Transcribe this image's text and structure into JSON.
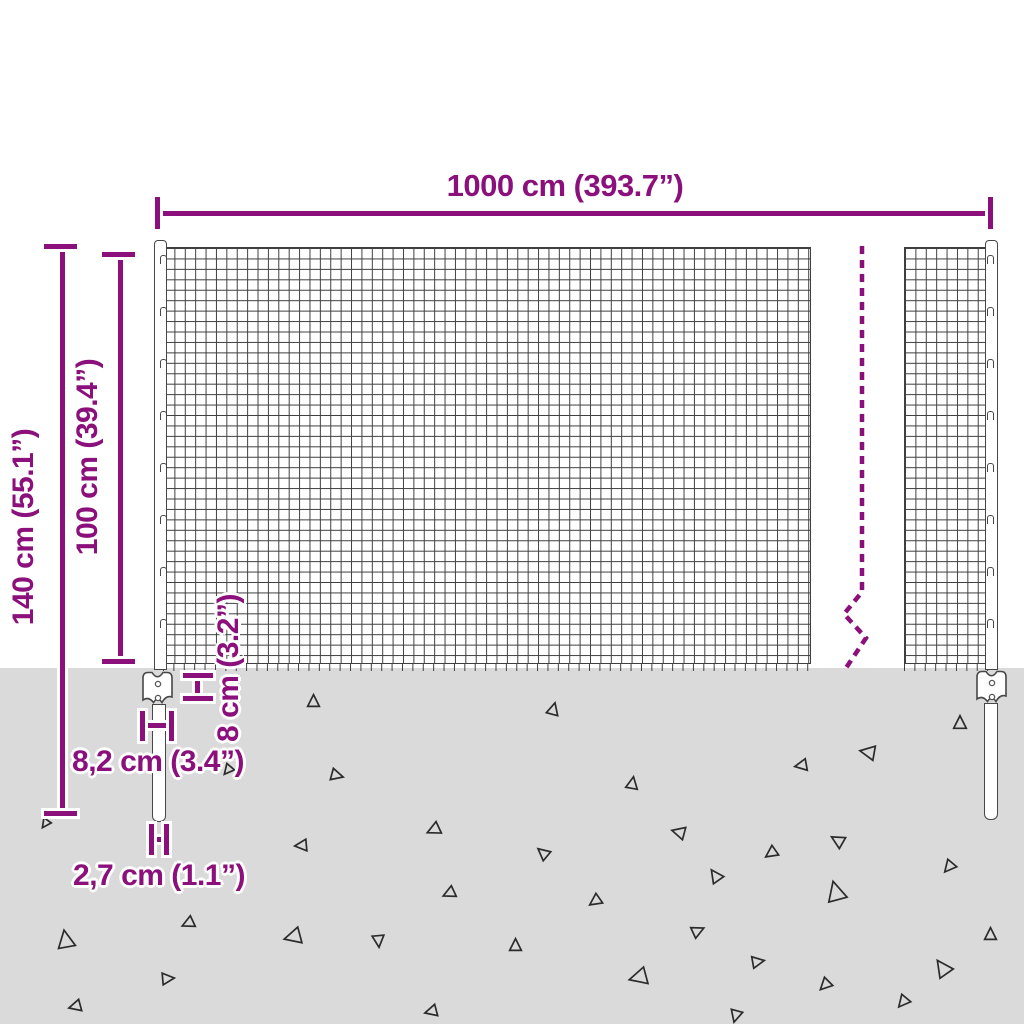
{
  "title": "Wire mesh fence dimension diagram",
  "colors": {
    "accent": "#8b107c",
    "ground": "#dadada",
    "wire": "#3f3f3f",
    "metal_outline": "#474747",
    "triangle_stroke": "#2b2b2b",
    "background": "#ffffff"
  },
  "labels": {
    "total_width": "1000 cm (393.7”)",
    "total_height": "140 cm (55.1”)",
    "mesh_height": "100 cm (39.4”)",
    "anchor_plate_height": "8 cm (3.2”)",
    "anchor_plate_width": "8,2 cm (3.4”)",
    "post_width": "2,7 cm (1.1”)"
  },
  "break_line": {
    "style": "dashed",
    "points": "862,246 862,592 844,614 866,638 846,668"
  },
  "triangles": [
    [
      313,
      700,
      13,
      0
    ],
    [
      553,
      708,
      13,
      15
    ],
    [
      960,
      722,
      14,
      0
    ],
    [
      867,
      752,
      16,
      -80
    ],
    [
      800,
      765,
      13,
      -100
    ],
    [
      337,
      775,
      13,
      105
    ],
    [
      632,
      782,
      13,
      10
    ],
    [
      227,
      770,
      11,
      -140
    ],
    [
      45,
      824,
      10,
      -145
    ],
    [
      300,
      845,
      13,
      -95
    ],
    [
      433,
      830,
      14,
      -115
    ],
    [
      678,
      832,
      14,
      -75
    ],
    [
      837,
      840,
      14,
      -60
    ],
    [
      770,
      853,
      13,
      -125
    ],
    [
      542,
      852,
      13,
      -50
    ],
    [
      715,
      875,
      14,
      -35
    ],
    [
      948,
      867,
      13,
      -140
    ],
    [
      835,
      890,
      21,
      -15
    ],
    [
      448,
      893,
      13,
      -115
    ],
    [
      594,
      901,
      13,
      -125
    ],
    [
      65,
      938,
      19,
      -10
    ],
    [
      187,
      923,
      13,
      -115
    ],
    [
      292,
      937,
      18,
      -105
    ],
    [
      378,
      941,
      13,
      175
    ],
    [
      698,
      930,
      13,
      65
    ],
    [
      515,
      944,
      13,
      0
    ],
    [
      990,
      933,
      13,
      0
    ],
    [
      758,
      961,
      13,
      80
    ],
    [
      942,
      967,
      18,
      -35
    ],
    [
      637,
      977,
      19,
      -105
    ],
    [
      824,
      985,
      13,
      -135
    ],
    [
      168,
      978,
      13,
      85
    ],
    [
      74,
      1006,
      13,
      -105
    ],
    [
      430,
      1011,
      13,
      -105
    ],
    [
      902,
      1002,
      13,
      -140
    ],
    [
      735,
      1016,
      13,
      -165
    ]
  ],
  "clips": {
    "left_post_ys": [
      255,
      307,
      359,
      411,
      463,
      515,
      567,
      619
    ],
    "right_post_ys": [
      255,
      307,
      359,
      411,
      463,
      515,
      567,
      619
    ]
  }
}
